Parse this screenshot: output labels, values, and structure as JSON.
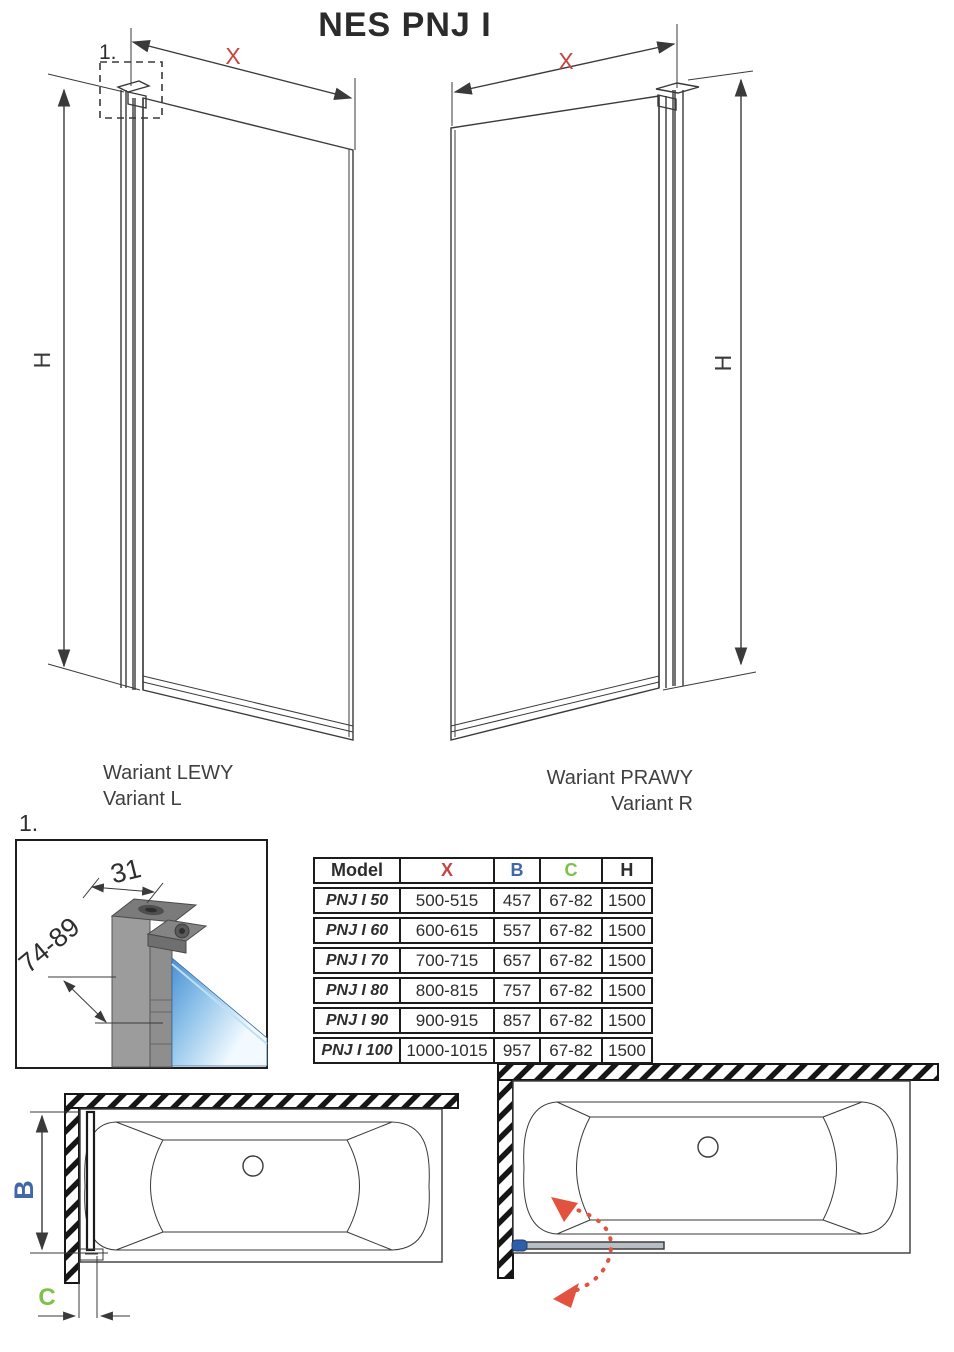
{
  "title": "NES PNJ I",
  "colors": {
    "dim_x_red": "#C84440",
    "dim_b_blue": "#4068A8",
    "dim_c_green": "#7CC247",
    "swing_arrow_red": "#E2523F",
    "glass_blue": "#4A8FD3",
    "line": "#3A3A3A"
  },
  "variants": {
    "left": {
      "caption_pl": "Wariant LEWY",
      "caption_en": "Variant L",
      "dim_width_label": "X",
      "dim_height_label": "H",
      "detail_marker": "1."
    },
    "right": {
      "caption_pl": "Wariant PRAWY",
      "caption_en": "Variant R",
      "dim_width_label": "X",
      "dim_height_label": "H"
    }
  },
  "detail_view": {
    "marker": "1.",
    "profile_width_mm": "31",
    "adjustment_range_mm": "74-89"
  },
  "size_table": {
    "headers": [
      "Model",
      "X",
      "B",
      "C",
      "H"
    ],
    "rows": [
      [
        "PNJ I 50",
        "500-515",
        "457",
        "67-82",
        "1500"
      ],
      [
        "PNJ I 60",
        "600-615",
        "557",
        "67-82",
        "1500"
      ],
      [
        "PNJ I 70",
        "700-715",
        "657",
        "67-82",
        "1500"
      ],
      [
        "PNJ I 80",
        "800-815",
        "757",
        "67-82",
        "1500"
      ],
      [
        "PNJ I 90",
        "900-915",
        "857",
        "67-82",
        "1500"
      ],
      [
        "PNJ I 100",
        "1000-1015",
        "957",
        "67-82",
        "1500"
      ]
    ]
  },
  "plan_views": {
    "left": {
      "width_label": "B",
      "gap_label": "C"
    },
    "right": {}
  }
}
